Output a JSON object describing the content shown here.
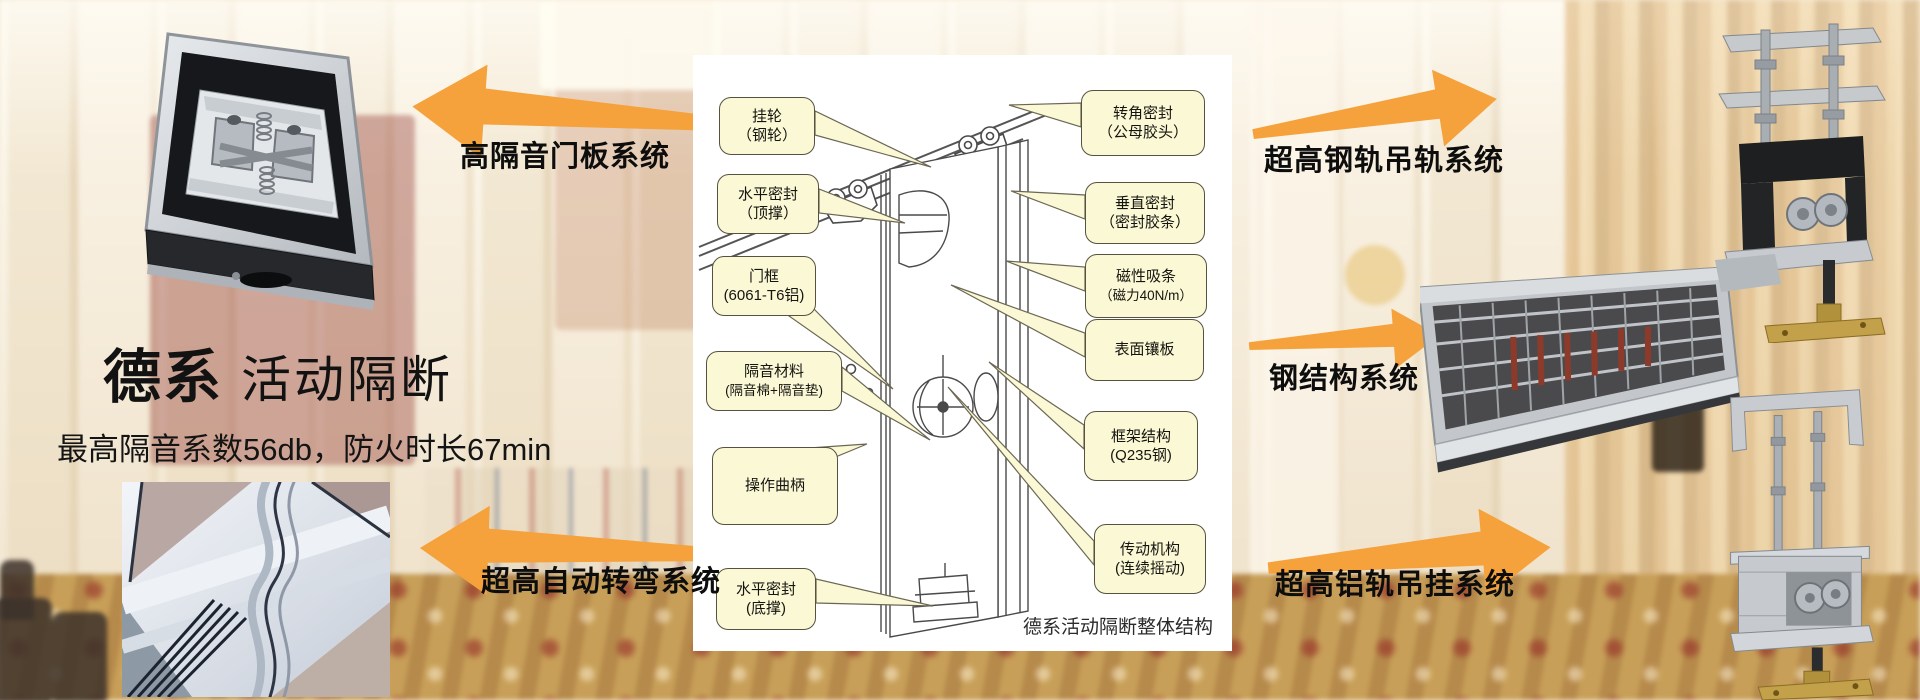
{
  "slide": {
    "title": {
      "brand": "德系",
      "product": "活动隔断",
      "subtitle": "最高隔音系数56db，防火时长67min"
    },
    "system_labels": {
      "top_left": "高隔音门板系统",
      "bottom_left": "超高自动转弯系统",
      "top_right": "超高钢轨吊轨系统",
      "middle_right": "钢结构系统",
      "bottom_right": "超高铝轨吊挂系统"
    },
    "diagram": {
      "caption": "德系活动隔断整体结构",
      "callouts_left": [
        {
          "line1": "挂轮",
          "line2": "（钢轮）"
        },
        {
          "line1": "水平密封",
          "line2": "（顶撑）"
        },
        {
          "line1": "门框",
          "line2": "(6061-T6铝)"
        },
        {
          "line1": "隔音材料",
          "line2": "(隔音棉+隔音垫)"
        },
        {
          "line1": "操作曲柄",
          "line2": ""
        },
        {
          "line1": "水平密封",
          "line2": "(底撑)"
        }
      ],
      "callouts_right": [
        {
          "line1": "转角密封",
          "line2": "（公母胶头）"
        },
        {
          "line1": "垂直密封",
          "line2": "（密封胶条）"
        },
        {
          "line1": "磁性吸条",
          "line2": "（磁力40N/m）"
        },
        {
          "line1": "表面镶板",
          "line2": ""
        },
        {
          "line1": "框架结构",
          "line2": "(Q235钢)"
        },
        {
          "line1": "传动机构",
          "line2": "(连续摇动)"
        }
      ]
    },
    "colors": {
      "arrow_orange": "#F6A23C",
      "callout_fill": "#FBF8D6",
      "callout_border": "#56523F"
    }
  }
}
